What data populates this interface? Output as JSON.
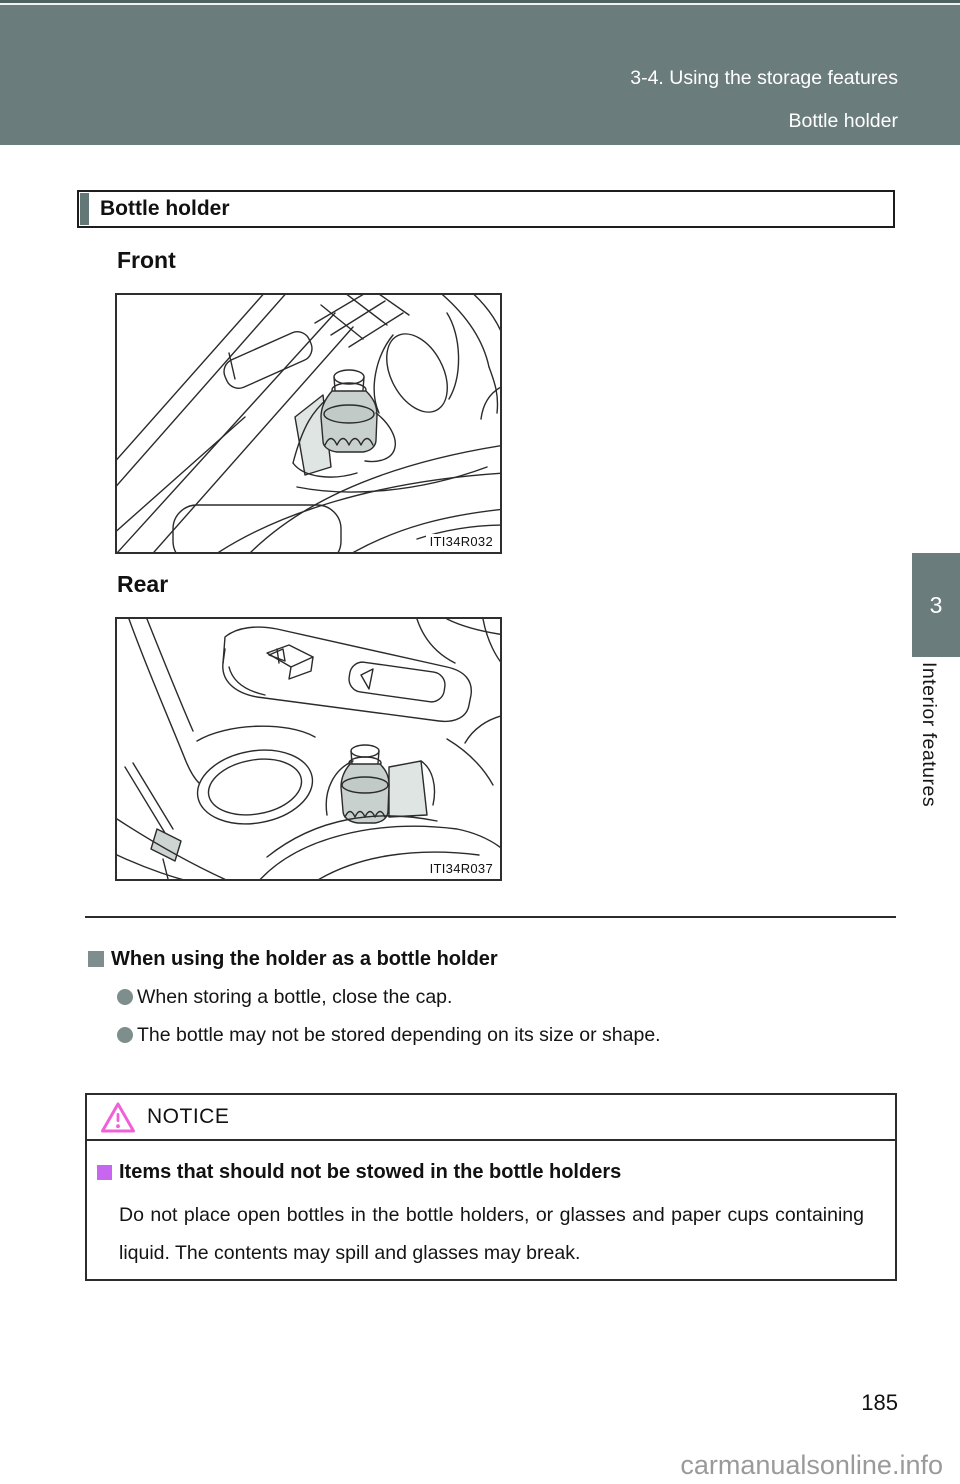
{
  "header_band": {
    "line1": "3-4. Using the storage features",
    "line2": "Bottle holder"
  },
  "section_title": "Bottle holder",
  "figures": {
    "front": {
      "label": "Front",
      "code": "ITI34R032"
    },
    "rear": {
      "label": "Rear",
      "code": "ITI34R037"
    }
  },
  "side_tab": {
    "number": "3",
    "label": "Interior features"
  },
  "info": {
    "heading": "When using the holder as a bottle holder",
    "bullets": [
      "When storing a bottle, close the cap.",
      "The bottle may not be stored depending on its size or shape."
    ]
  },
  "notice": {
    "title": "NOTICE",
    "heading": "Items that should not be stowed in the bottle holders",
    "body": "Do not place open bottles in the bottle holders, or glasses and paper cups containing liquid. The contents may spill and glasses may break."
  },
  "footer": {
    "page_number": "185",
    "watermark": "carmanualsonline.info"
  },
  "colors": {
    "band": "#6a7c7b",
    "bullet": "#7e8e8c",
    "notice_triangle": "#f060d8",
    "notice_bullet": "#c766ef",
    "watermark": "#9a9a9a"
  }
}
